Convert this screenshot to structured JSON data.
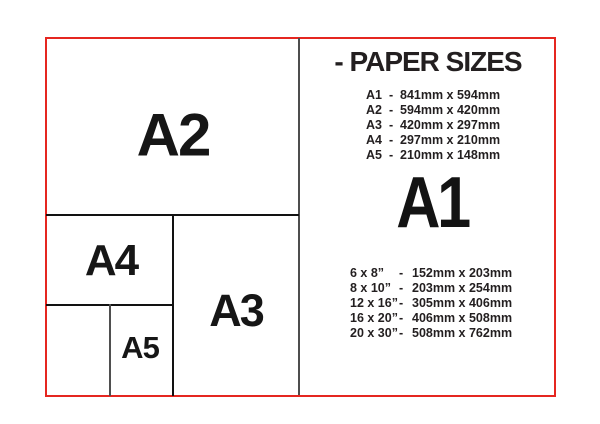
{
  "title": "- PAPER SIZES",
  "featured_size": "A1",
  "diagram": {
    "a2": "A2",
    "a3": "A3",
    "a4": "A4",
    "a5": "A5"
  },
  "metric_list": {
    "rows": [
      {
        "label": "A1",
        "dash": "-",
        "dims": "841mm x 594mm"
      },
      {
        "label": "A2",
        "dash": "-",
        "dims": "594mm x 420mm"
      },
      {
        "label": "A3",
        "dash": "-",
        "dims": "420mm x 297mm"
      },
      {
        "label": "A4",
        "dash": "-",
        "dims": "297mm x 210mm"
      },
      {
        "label": "A5",
        "dash": "-",
        "dims": "210mm x 148mm"
      }
    ]
  },
  "imperial_list": {
    "rows": [
      {
        "label": "6 x 8”",
        "dash": "-",
        "dims": "152mm x 203mm"
      },
      {
        "label": "8 x 10”",
        "dash": "-",
        "dims": "203mm x 254mm"
      },
      {
        "label": "12 x 16”",
        "dash": "-",
        "dims": "305mm x 406mm"
      },
      {
        "label": "16 x 20”",
        "dash": "-",
        "dims": "406mm x 508mm"
      },
      {
        "label": "20 x 30”",
        "dash": "-",
        "dims": "508mm x 762mm"
      }
    ]
  },
  "colors": {
    "frame_red": "#e52620",
    "line_black": "#121212",
    "divider_gray": "#4d4d4d",
    "text": "#231f20"
  }
}
